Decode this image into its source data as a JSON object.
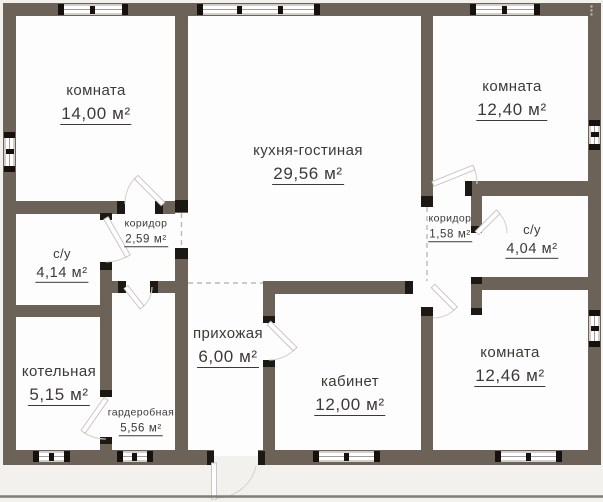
{
  "plan": {
    "rooms": [
      {
        "id": "bedroom-1",
        "name": "комната",
        "area": "14,00 м²"
      },
      {
        "id": "kitchen-living",
        "name": "кухня-гостиная",
        "area": "29,56 м²"
      },
      {
        "id": "bedroom-2",
        "name": "комната",
        "area": "12,40 м²"
      },
      {
        "id": "corridor-1",
        "name": "коридор",
        "area": "2,59 м²"
      },
      {
        "id": "bathroom-1",
        "name": "с/у",
        "area": "4,14 м²"
      },
      {
        "id": "boiler-room",
        "name": "котельная",
        "area": "5,15 м²"
      },
      {
        "id": "wardrobe",
        "name": "гардеробная",
        "area": "5,56 м²"
      },
      {
        "id": "hallway",
        "name": "прихожая",
        "area": "6,00 м²"
      },
      {
        "id": "study",
        "name": "кабинет",
        "area": "12,00 м²"
      },
      {
        "id": "corridor-2",
        "name": "коридор",
        "area": "1,58 м²"
      },
      {
        "id": "bathroom-2",
        "name": "с/у",
        "area": "4,04 м²"
      },
      {
        "id": "bedroom-3",
        "name": "комната",
        "area": "12,46 м²"
      }
    ],
    "colors": {
      "wall": "#6c6257",
      "floor": "#fdfdfd",
      "background": "#f2f1ee",
      "jamb": "#1c1915",
      "ground_line": "#817d77",
      "text": "#3c3a37"
    },
    "icons": {
      "more_options": "⋮"
    }
  }
}
